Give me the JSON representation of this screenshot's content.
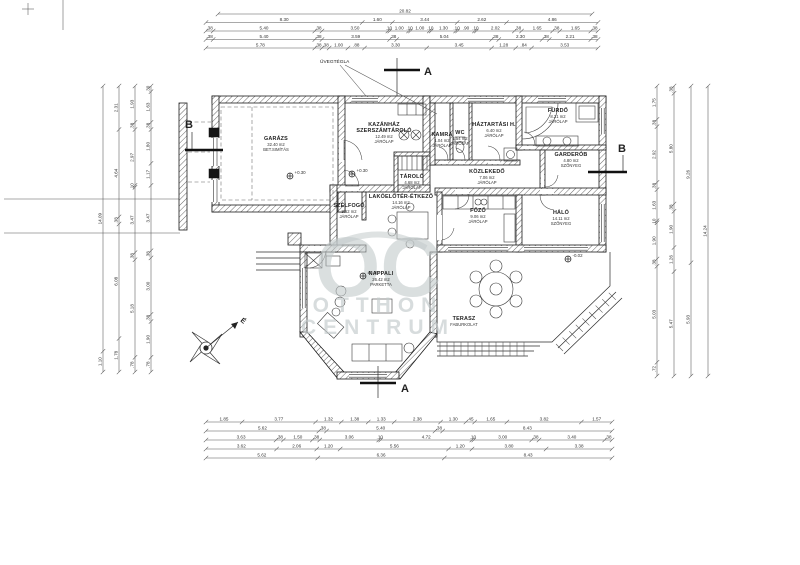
{
  "watermark": {
    "oc": "OC",
    "line1": "OTTHON",
    "line2": "CENTRUM",
    "color": "#c3cacb"
  },
  "compass": {
    "label": "É"
  },
  "section_marks": {
    "a_top": "A",
    "a_bottom": "A",
    "b_left": "B",
    "b_right": "B"
  },
  "annotations": {
    "uvegtegla": {
      "text": "ÜVEGTÉGLA"
    }
  },
  "levels": [
    {
      "text": "+0.30",
      "x": 290,
      "y": 172
    },
    {
      "text": "+0.30",
      "x": 352,
      "y": 170
    },
    {
      "text": "±0.00",
      "x": 363,
      "y": 272
    },
    {
      "text": "-0.02",
      "x": 568,
      "y": 255
    }
  ],
  "rooms": [
    {
      "id": "garazs",
      "name": [
        "GARÁZS"
      ],
      "area": "32.40 m2",
      "floor": "BET.SIMÍTÁS",
      "x": 276,
      "y": 140
    },
    {
      "id": "kazanhaz",
      "name": [
        "KAZÁNHÁZ",
        "SZERSZÁMTÁROLÓ"
      ],
      "area": "12.49 m2",
      "floor": "JÁRÓLAP",
      "x": 384,
      "y": 126
    },
    {
      "id": "tarolo",
      "name": [
        "TÁROLÓ"
      ],
      "area": "4.68 m2",
      "floor": "JÁRÓLAP",
      "x": 412,
      "y": 178
    },
    {
      "id": "szelfogo",
      "name": [
        "SZÉLFOGÓ"
      ],
      "area": "3.52 m2",
      "floor": "JÁRÓLAP",
      "x": 349,
      "y": 207
    },
    {
      "id": "etkezo",
      "name": [
        "LAKÓELŐTÉR-ÉTKEZŐ"
      ],
      "area": "14.16 m2",
      "floor": "JÁRÓLAP",
      "x": 401,
      "y": 198
    },
    {
      "id": "kamra",
      "name": [
        "KAMRA"
      ],
      "area": "1.04 m2",
      "floor": "JÁRÓLAP",
      "x": 442,
      "y": 136
    },
    {
      "id": "wc",
      "name": [
        "WC"
      ],
      "area": "1.54 m2",
      "floor": "JÁRÓLAP",
      "x": 460,
      "y": 134
    },
    {
      "id": "haztartasi",
      "name": [
        "HÁZTARTÁSI H."
      ],
      "area": "6.40 m2",
      "floor": "JÁRÓLAP",
      "x": 494,
      "y": 126
    },
    {
      "id": "kozlekedo",
      "name": [
        "KÖZLEKEDŐ"
      ],
      "area": "7.06 m2",
      "floor": "JÁRÓLAP",
      "x": 487,
      "y": 173
    },
    {
      "id": "furdo",
      "name": [
        "FÜRDŐ"
      ],
      "area": "8.21 m2",
      "floor": "JÁRÓLAP",
      "x": 558,
      "y": 112
    },
    {
      "id": "garderob",
      "name": [
        "GARDERÓB"
      ],
      "area": "4.80 m2",
      "floor": "SZŐNYEG",
      "x": 571,
      "y": 156
    },
    {
      "id": "halo",
      "name": [
        "HÁLÓ"
      ],
      "area": "14.11 m2",
      "floor": "SZŐNYEG",
      "x": 561,
      "y": 214
    },
    {
      "id": "fozo",
      "name": [
        "FŐZŐ"
      ],
      "area": "9.06 m2",
      "floor": "JÁRÓLAP",
      "x": 478,
      "y": 212
    },
    {
      "id": "nappali",
      "name": [
        "NAPPALI"
      ],
      "area": "26.42 m2",
      "floor": "PARKETTA",
      "x": 381,
      "y": 275
    },
    {
      "id": "terasz",
      "name": [
        "TERASZ"
      ],
      "area": "",
      "floor": "FABURKOLAT",
      "x": 464,
      "y": 320
    }
  ],
  "dimensions": {
    "top": [
      {
        "y": 14,
        "x1": 218,
        "x2": 592,
        "values": [
          "20.82"
        ]
      },
      {
        "y": 22.5,
        "x1": 206,
        "x2": 598,
        "values": [
          "8.30",
          "1.60",
          "3.44",
          "2.62",
          "4.86"
        ]
      },
      {
        "y": 31,
        "x1": 206,
        "x2": 598,
        "values": [
          ".38",
          "5.40",
          ".38",
          "3.50",
          ".10",
          "1.00",
          ".10",
          "1.00",
          ".10",
          "1.30",
          ".10",
          ".90",
          ".10",
          "2.02",
          ".38",
          "1.65",
          ".38",
          "1.65",
          ".38"
        ]
      },
      {
        "y": 39.5,
        "x1": 206,
        "x2": 598,
        "values": [
          ".38",
          "5.40",
          ".38",
          "3.59",
          ".38",
          "5.04",
          ".38",
          "2.30",
          ".38",
          "2.21",
          ".38"
        ]
      },
      {
        "y": 48,
        "x1": 206,
        "x2": 598,
        "values": [
          "5.78",
          ".38",
          ".38",
          "1.00",
          ".88",
          "3.30",
          "3.45",
          "1.28",
          ".84",
          "3.53"
        ]
      }
    ],
    "bottom": [
      {
        "y": 422,
        "x1": 206,
        "x2": 612,
        "values": [
          "1.85",
          "3.77",
          "1.32",
          "1.38",
          "1.33",
          "2.38",
          "1.30",
          ".45",
          "1.65",
          "3.82",
          "1.57"
        ]
      },
      {
        "y": 431,
        "x1": 206,
        "x2": 612,
        "values": [
          "5.62",
          ".38",
          "5.40",
          ".38",
          "8.43"
        ]
      },
      {
        "y": 440,
        "x1": 206,
        "x2": 612,
        "values": [
          "3.63",
          ".38",
          "1.50",
          ".38",
          "3.06",
          ".10",
          "4.72",
          ".10",
          "3.00",
          ".38",
          "3.40",
          ".38"
        ]
      },
      {
        "y": 449,
        "x1": 206,
        "x2": 612,
        "values": [
          "3.62",
          "2.06",
          "1.20",
          "5.56",
          "1.20",
          "3.80",
          "3.38"
        ]
      },
      {
        "y": 458,
        "x1": 206,
        "x2": 612,
        "values": [
          "5.62",
          "6.36",
          "8.43"
        ]
      }
    ],
    "left": [
      {
        "x": 103,
        "y1": 86,
        "y2": 372,
        "values": [
          "14.09",
          "1.10"
        ]
      },
      {
        "x": 119,
        "y1": 86,
        "y2": 372,
        "values": [
          "2.31",
          "4.64",
          ".38",
          "6.08",
          "1.78"
        ]
      },
      {
        "x": 135,
        "y1": 86,
        "y2": 372,
        "values": [
          "1.93",
          ".38",
          "2.97",
          ".10",
          "3.47",
          ".38",
          "5.18",
          ".78"
        ]
      },
      {
        "x": 151,
        "y1": 86,
        "y2": 372,
        "values": [
          ".30",
          "1.63",
          ".38",
          "1.80",
          "1.17",
          "3.47",
          ".38",
          "3.00",
          ".38",
          "1.90",
          ".78"
        ]
      }
    ],
    "right": [
      {
        "x": 657,
        "y1": 86,
        "y2": 376,
        "values": [
          "1.75",
          ".38",
          "2.92",
          ".38",
          "1.63",
          ".10",
          "1.90",
          ".38",
          "5.03",
          ".72"
        ]
      },
      {
        "x": 674,
        "y1": 86,
        "y2": 376,
        "values": [
          ".38",
          "5.80",
          ".38",
          "1.90",
          "1.26",
          "5.47"
        ]
      },
      {
        "x": 691,
        "y1": 86,
        "y2": 376,
        "values": [
          "9.26",
          "5.93"
        ]
      },
      {
        "x": 708,
        "y1": 86,
        "y2": 376,
        "values": [
          "14.24"
        ]
      }
    ]
  }
}
